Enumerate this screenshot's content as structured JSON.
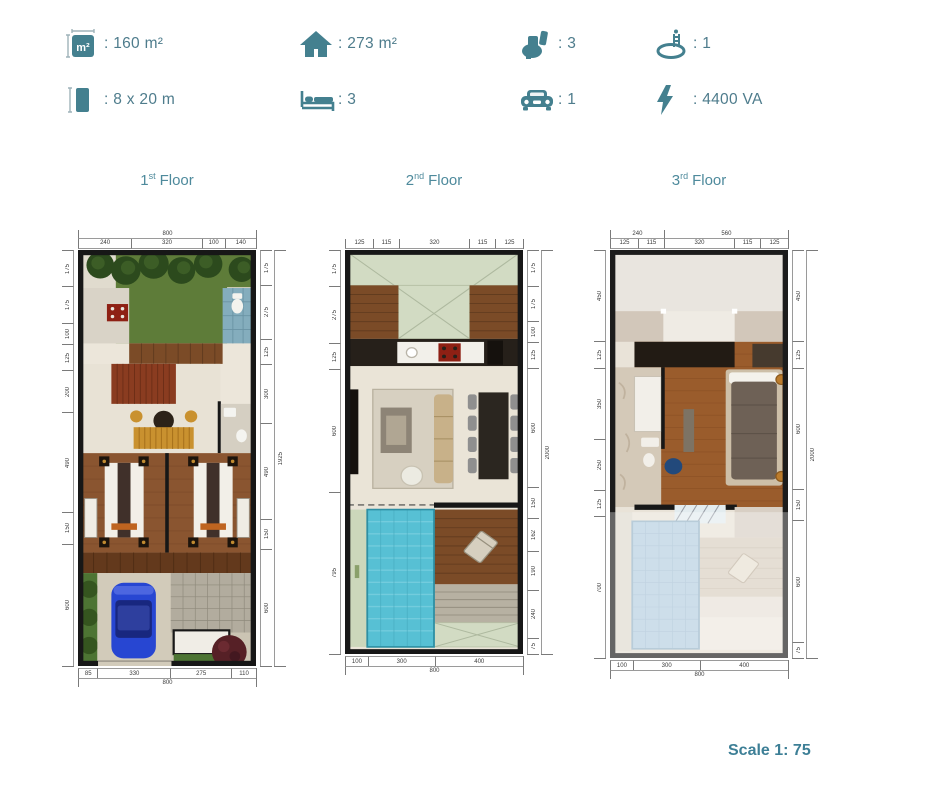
{
  "accent": "#44808f",
  "specs": [
    {
      "name": "land-area",
      "value": ": 160 m²"
    },
    {
      "name": "building-area",
      "value": ": 273 m²"
    },
    {
      "name": "toilets",
      "value": ": 3"
    },
    {
      "name": "pools",
      "value": ": 1"
    },
    {
      "name": "plot-size",
      "value": ": 8 x 20 m"
    },
    {
      "name": "bedrooms",
      "value": ": 3"
    },
    {
      "name": "carports",
      "value": ": 1"
    },
    {
      "name": "power",
      "value": ": 4400 VA"
    }
  ],
  "icon_glyphs": {
    "area": "m²"
  },
  "floors": [
    {
      "label_num": "1",
      "label_ord": "st",
      "label_word": "Floor",
      "dims": {
        "top_total": [
          "800"
        ],
        "top": [
          "240",
          "320",
          "100",
          "140"
        ],
        "left": [
          "175",
          "175",
          "100",
          "125",
          "200",
          "490",
          "150",
          "600"
        ],
        "right": [
          "175",
          "275",
          "125",
          "300",
          "490",
          "150",
          "600"
        ],
        "right_total": [
          "1925"
        ],
        "bottom": [
          "85",
          "330",
          "275",
          "110"
        ],
        "bottom_total": [
          "800"
        ]
      }
    },
    {
      "label_num": "2",
      "label_ord": "nd",
      "label_word": "Floor",
      "dims": {
        "top": [
          "125",
          "115",
          "320",
          "115",
          "125"
        ],
        "left": [
          "175",
          "275",
          "125",
          "600",
          "795"
        ],
        "right": [
          "175",
          "175",
          "100",
          "125",
          "600",
          "150",
          "162",
          "190",
          "240",
          "75"
        ],
        "right_total": [
          "2000"
        ],
        "bottom": [
          "100",
          "300",
          "400"
        ],
        "bottom_total": [
          "800"
        ]
      }
    },
    {
      "label_num": "3",
      "label_ord": "rd",
      "label_word": "Floor",
      "dims": {
        "top_total": [
          "240",
          "560"
        ],
        "top": [
          "125",
          "115",
          "320",
          "115",
          "125"
        ],
        "left": [
          "450",
          "125",
          "350",
          "250",
          "125",
          "700"
        ],
        "right": [
          "450",
          "125",
          "600",
          "150",
          "600",
          "75"
        ],
        "right_total": [
          "2000"
        ],
        "bottom": [
          "100",
          "300",
          "400"
        ],
        "bottom_total": [
          "800"
        ]
      }
    }
  ],
  "scale_label": "Scale 1: 75"
}
